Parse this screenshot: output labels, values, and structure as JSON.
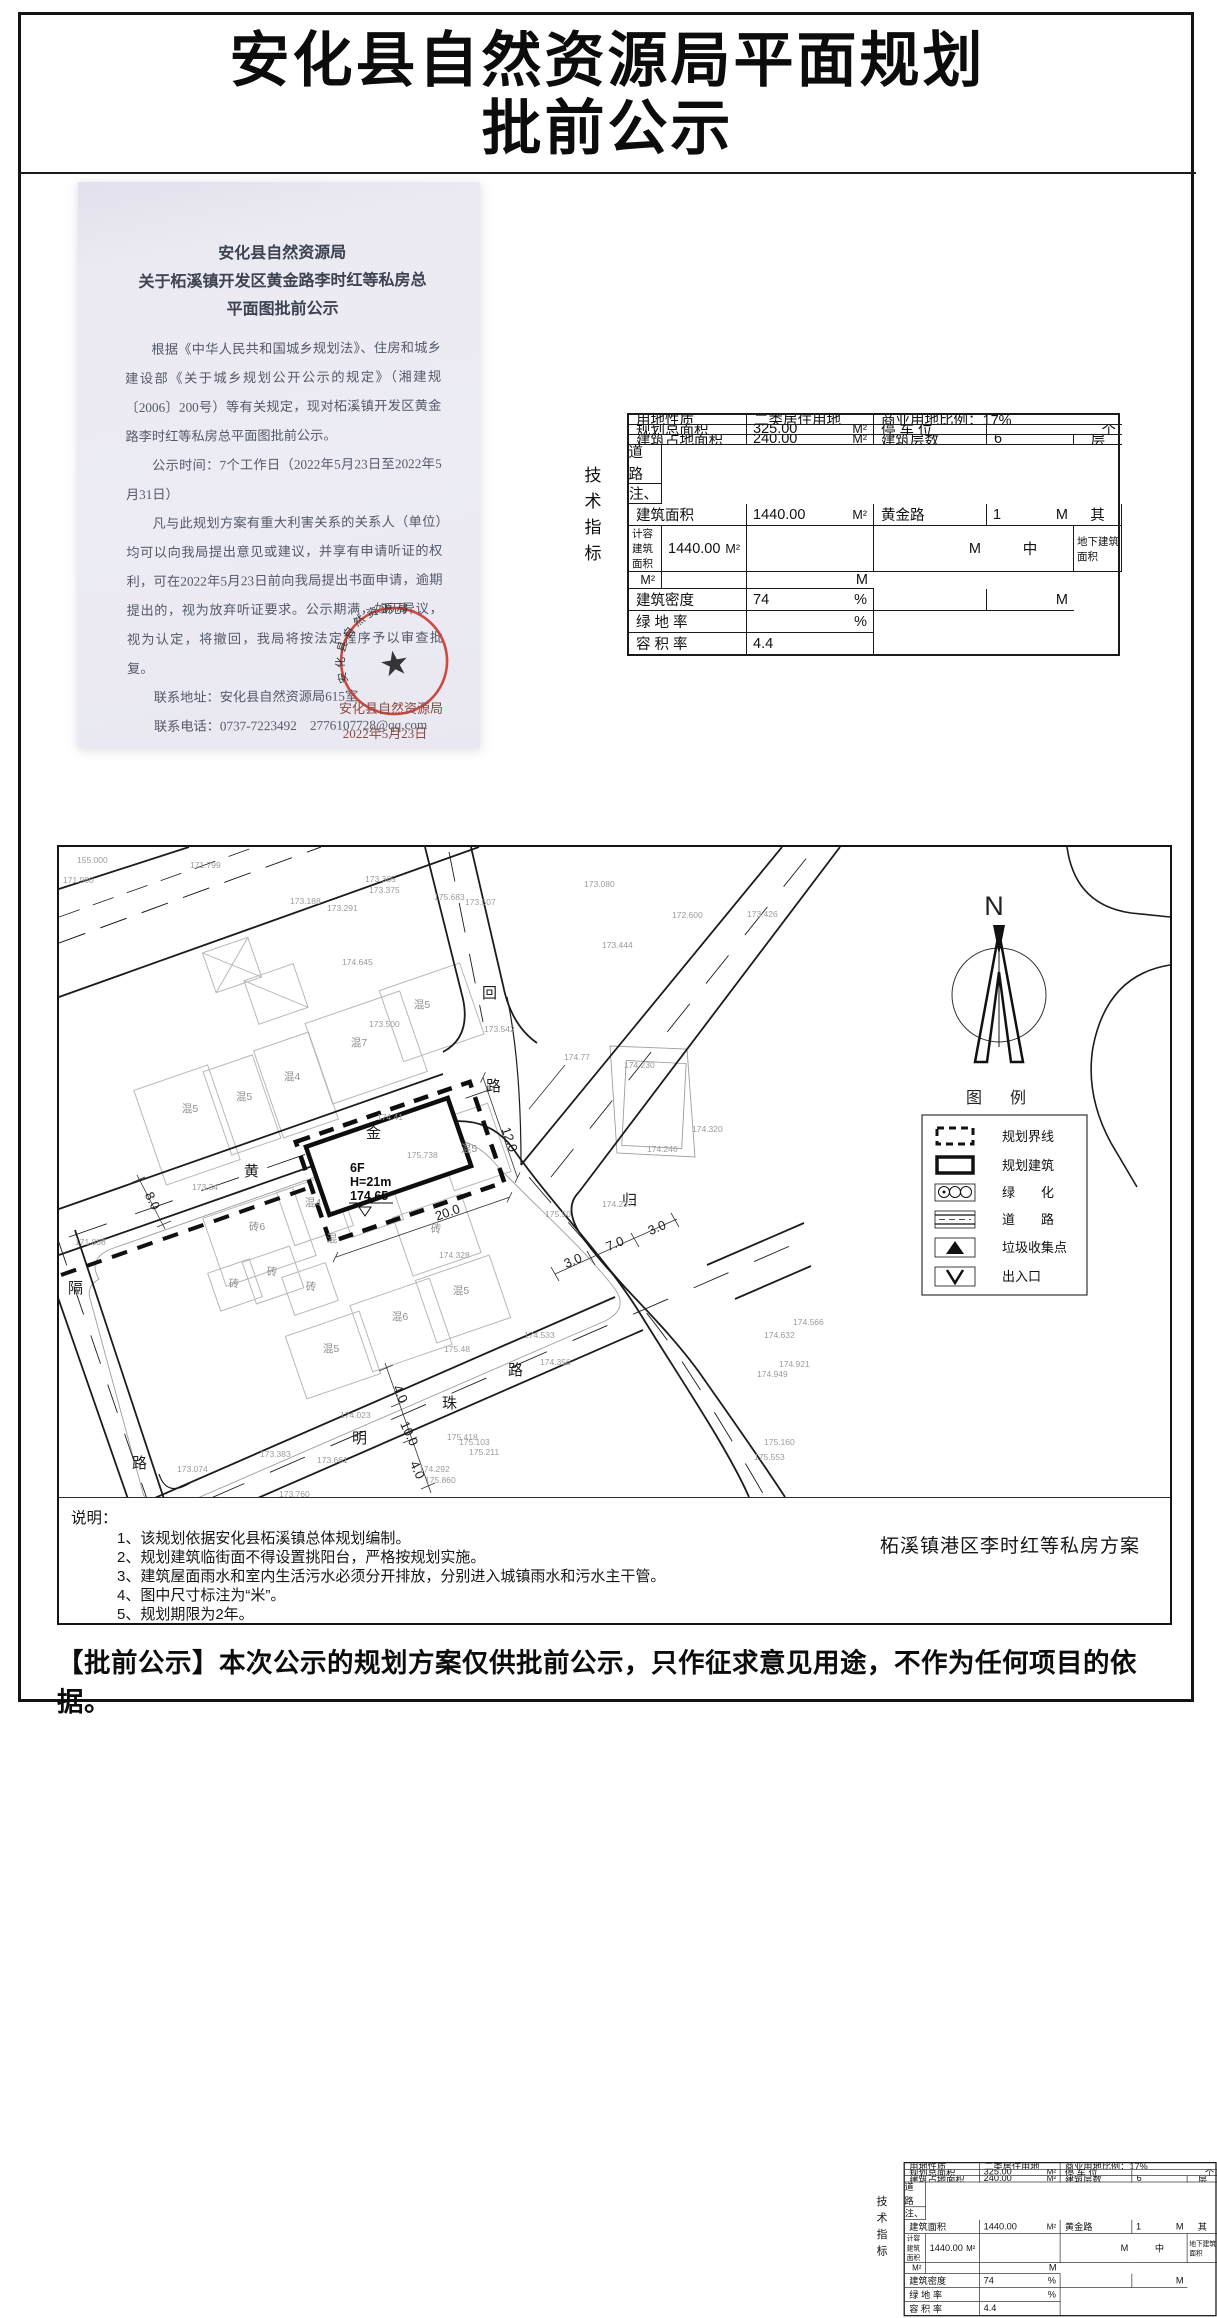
{
  "title": {
    "line1": "安化县自然资源局平面规划",
    "line2": "批前公示"
  },
  "letter": {
    "heading": [
      "安化县自然资源局",
      "关于柘溪镇开发区黄金路李时红等私房总",
      "平面图批前公示"
    ],
    "para1": "根据《中华人民共和国城乡规划法》、住房和城乡建设部《关于城乡规划公开公示的规定》（湘建规〔2006〕200号）等有关规定，现对柘溪镇开发区黄金路李时红等私房总平面图批前公示。",
    "para2": "公示时间：7个工作日（2022年5月23日至2022年5月31日）",
    "para3": "凡与此规划方案有重大利害关系的关系人（单位）均可以向我局提出意见或建议，并享有申请听证的权利，可在2022年5月23日前向我局提出书面申请，逾期提出的，视为放弃听证要求。公示期满，如无异议，视为认定，将撤回，我局将按法定程序予以审查批复。",
    "contact_address": "联系地址：安化县自然资源局615室",
    "contact_phone": "联系电话：0737-7223492    2776107728@qq.com",
    "website": "网上公示地址：www.anhua.gov.cn",
    "stamp_org": "安化县自然资源局",
    "stamp_date": "2022年5月23日",
    "stamp_arc": "安化县自然资源局",
    "stamp_color": "#c83a31"
  },
  "tech": {
    "side_label": [
      "技",
      "术",
      "指",
      "标"
    ],
    "land_use_label": "用地性质",
    "land_use_value": "二类居住用地",
    "commercial": "商业用地比例：17%",
    "total_area_label": "规划总面积",
    "total_area_value": "325.00",
    "footprint_label": "建筑占地面积",
    "footprint_value": "240.00",
    "gfa_label": "建筑面积",
    "gfa_value": "1440.00",
    "qi": "其",
    "zhong": "中",
    "capacity_label": "计容建筑面积",
    "capacity_value": "1440.00",
    "underground_label": "地下建筑面积",
    "underground_value": "",
    "density_label": "建筑密度",
    "density_value": "74",
    "green_label": "绿 地 率",
    "green_value": "",
    "far_label": "容 积 率",
    "far_value": "4.4",
    "parking_label": "停 车 位",
    "parking_value": "",
    "parking_unit": "个",
    "floors_label": "建筑层数",
    "floors_value": "6",
    "floors_unit": "层",
    "setback": [
      "后　退",
      "道　路",
      "红　线"
    ],
    "setback_road": "黄金路",
    "setback_dist": "1",
    "remark_label": "备注、其他",
    "unit_m2": "M²",
    "unit_m": "M",
    "unit_pct": "%"
  },
  "plan": {
    "north": "N",
    "legend_title": "图　例",
    "legend": [
      "规划界线",
      "规划建筑",
      "绿　　化",
      "道　　路",
      "垃圾收集点",
      "出入口"
    ],
    "caption": "柘溪镇港区李时红等私房方案",
    "notes_title": "说明：",
    "notes": [
      "1、该规划依据安化县柘溪镇总体规划编制。",
      "2、规划建筑临街面不得设置挑阳台，严格按规划实施。",
      "3、建筑屋面雨水和室内生活污水必须分开排放，分别进入城镇雨水和污水主干管。",
      "4、图中尺寸标注为“米”。",
      "5、规划期限为2年。"
    ],
    "roads": [
      "黄",
      "金",
      "路",
      "回",
      "归",
      "明",
      "珠",
      "路",
      "隔",
      "路"
    ],
    "parcel": {
      "f": "6F",
      "h": "H=21m",
      "elev": "174.65"
    },
    "dims": [
      "20.0",
      "12.0",
      "8.0",
      "4.0",
      "10.0",
      "4.0",
      "3.0",
      "7.0",
      "3.0"
    ],
    "bldg": [
      "混5",
      "混5",
      "混4",
      "混7",
      "混5",
      "混5",
      "砖6",
      "混4",
      "混",
      "砖",
      "砖",
      "砖",
      "砖",
      "混5",
      "混6",
      "混5"
    ],
    "elev": [
      "155.000",
      "171.799",
      "173.188",
      "173.291",
      "173.365",
      "173.375",
      "175.683",
      "173.507",
      "173.080",
      "173.444",
      "174.645",
      "173.500",
      "173.542",
      "174.77",
      "174.41",
      "173.34",
      "175.738",
      "175.50",
      "174.328",
      "171.888",
      "175.48",
      "174.533",
      "174.356",
      "173.383",
      "173.661",
      "173.074",
      "173.760",
      "174.023",
      "174.292",
      "175.860",
      "175.418",
      "175.103",
      "175.211",
      "174.230",
      "174.246",
      "174.237",
      "174.566",
      "174.632",
      "174.921",
      "174.949",
      "175.160",
      "175.553",
      "171.960",
      "172.600",
      "173.426",
      "174.320"
    ]
  },
  "footer": "【批前公示】本次公示的规划方案仅供批前公示，只作征求意见用途，不作为任何项目的依据。"
}
